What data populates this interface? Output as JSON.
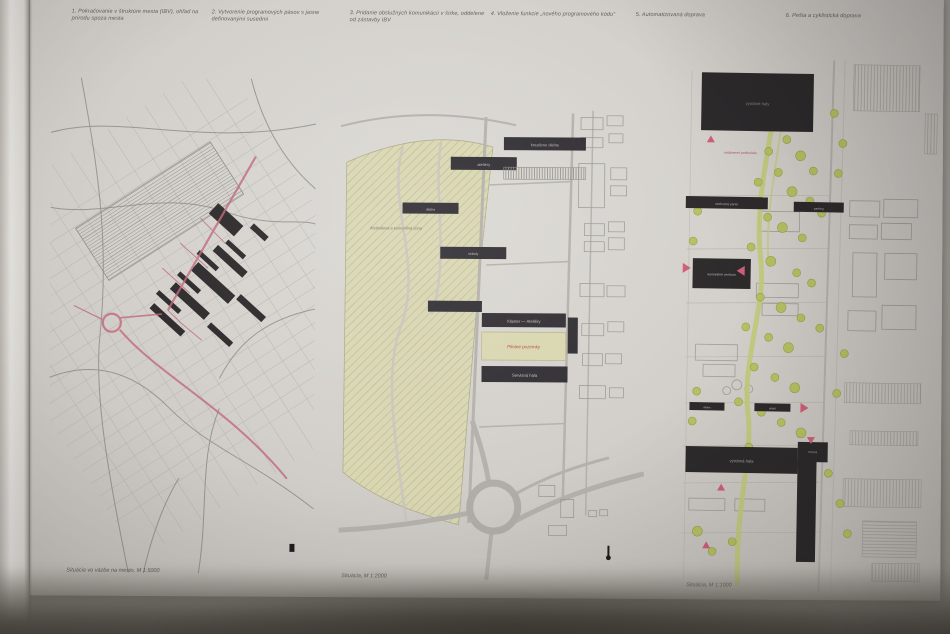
{
  "poster": {
    "headings": [
      "1. Pokračovanie v štruktúre mesta (IBV), ohľad na prírodu spoza mesta",
      "2. Vytvorenie programových pásov s jasne definovanými susedmi",
      "3. Pridanie obslužných komunikácií v šírke, oddelene od zástavby IBV",
      "4. Vloženie funkcie „nového programového kódu“",
      "5. Automatizovaná doprava",
      "6. Pešia a cyklistická doprava"
    ],
    "panels": {
      "left": {
        "caption": "Situácia vo väzbe na mesto, M 1:5000"
      },
      "middle": {
        "caption": "Situácia, M 1:2000",
        "labels": {
          "bar_a": "kreatívne dielne",
          "bar_b": "ateliéry",
          "bar_c": "dielne",
          "bar_d": "sklady",
          "field_note": "festivalová a komunitná zóna",
          "cluster": "Klaster — Ateliéry",
          "pilot": "Pilotné pozemky",
          "service": "Servisná hala"
        }
      },
      "right": {
        "caption": "Situácia, M 1:1000",
        "labels": {
          "block_top": "výrobné haly",
          "note_red": "nadzemné parkovisko",
          "bar_left": "obchodný parter",
          "bar_right": "parking",
          "cowork": "komunitné centrum",
          "bar_s1": "dielne",
          "bar_s2": "sklad",
          "hall": "výrobná hala",
          "l_building": "tržnica"
        }
      }
    }
  },
  "colors": {
    "poster": "#d5d3ce",
    "ink_black": "#2e2c2d",
    "road_red": "#c4707c",
    "field_beige": "#d9d6ae",
    "tree_green": "#b6c163",
    "marker_pink": "#ce5f78"
  }
}
